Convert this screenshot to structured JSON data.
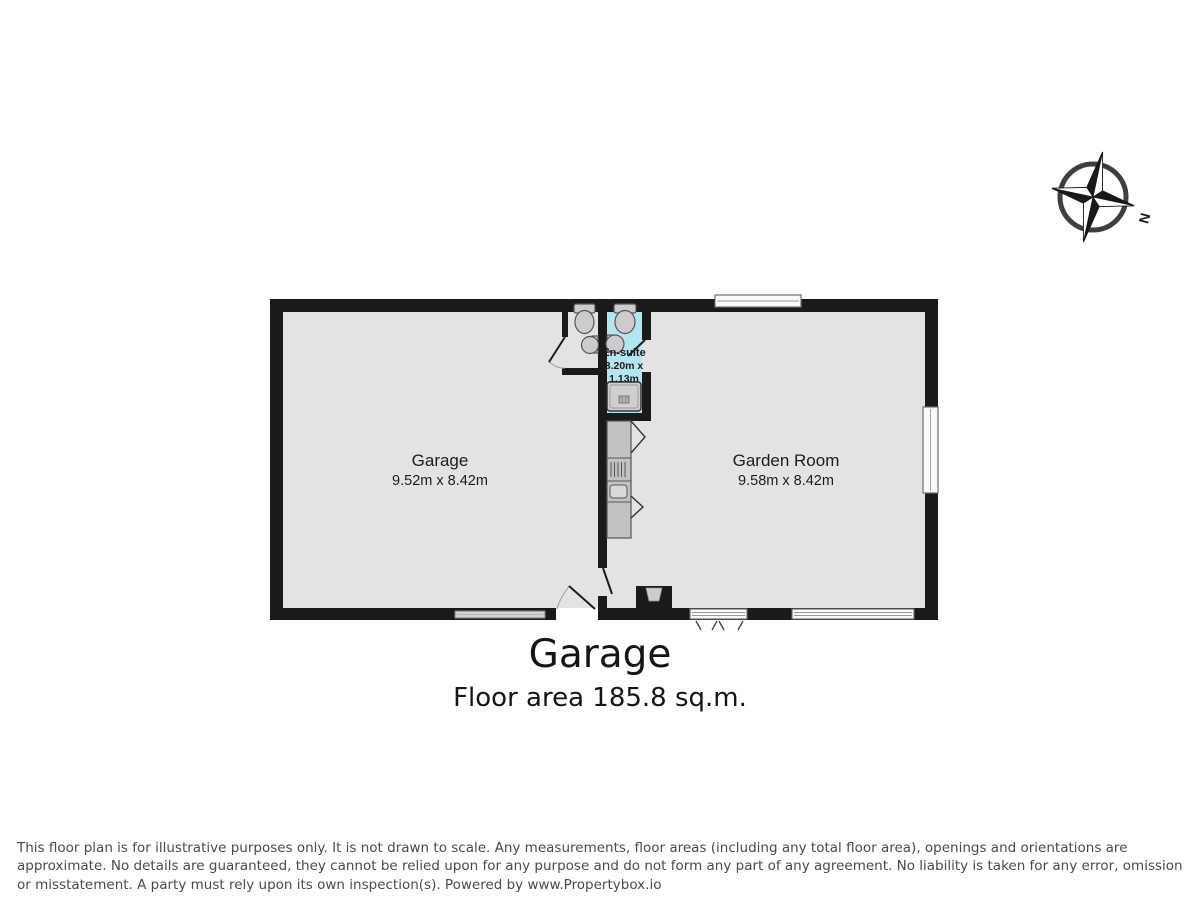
{
  "plan": {
    "rooms": {
      "garage": {
        "name": "Garage",
        "dims": "9.52m x 8.42m"
      },
      "garden_room": {
        "name": "Garden Room",
        "dims": "9.58m x 8.42m"
      },
      "ensuite": {
        "name": "En-suite",
        "dims_line1": "3.20m x",
        "dims_line2": "1.13m"
      }
    },
    "compass": {
      "north_label": "N"
    }
  },
  "summary": {
    "title": "Garage",
    "floor_area": "Floor area 185.8 sq.m."
  },
  "footer": {
    "disclaimer": "This floor plan is for illustrative purposes only. It is not drawn to scale. Any measurements, floor areas (including any total floor area), openings and orientations are approximate. No details are guaranteed, they cannot be relied upon for any purpose and do not form any part of any agreement. No liability is taken for any error, omission or misstatement. A party must rely upon its own inspection(s). Powered by www.Propertybox.io"
  },
  "colors": {
    "wall": "#1a1a1a",
    "room_fill": "#e3e3e3",
    "ensuite_fill": "#b4e6f2",
    "fixture_fill": "#cccccc",
    "window_fill": "#fafafa",
    "footer_text": "#4a4a4a"
  }
}
